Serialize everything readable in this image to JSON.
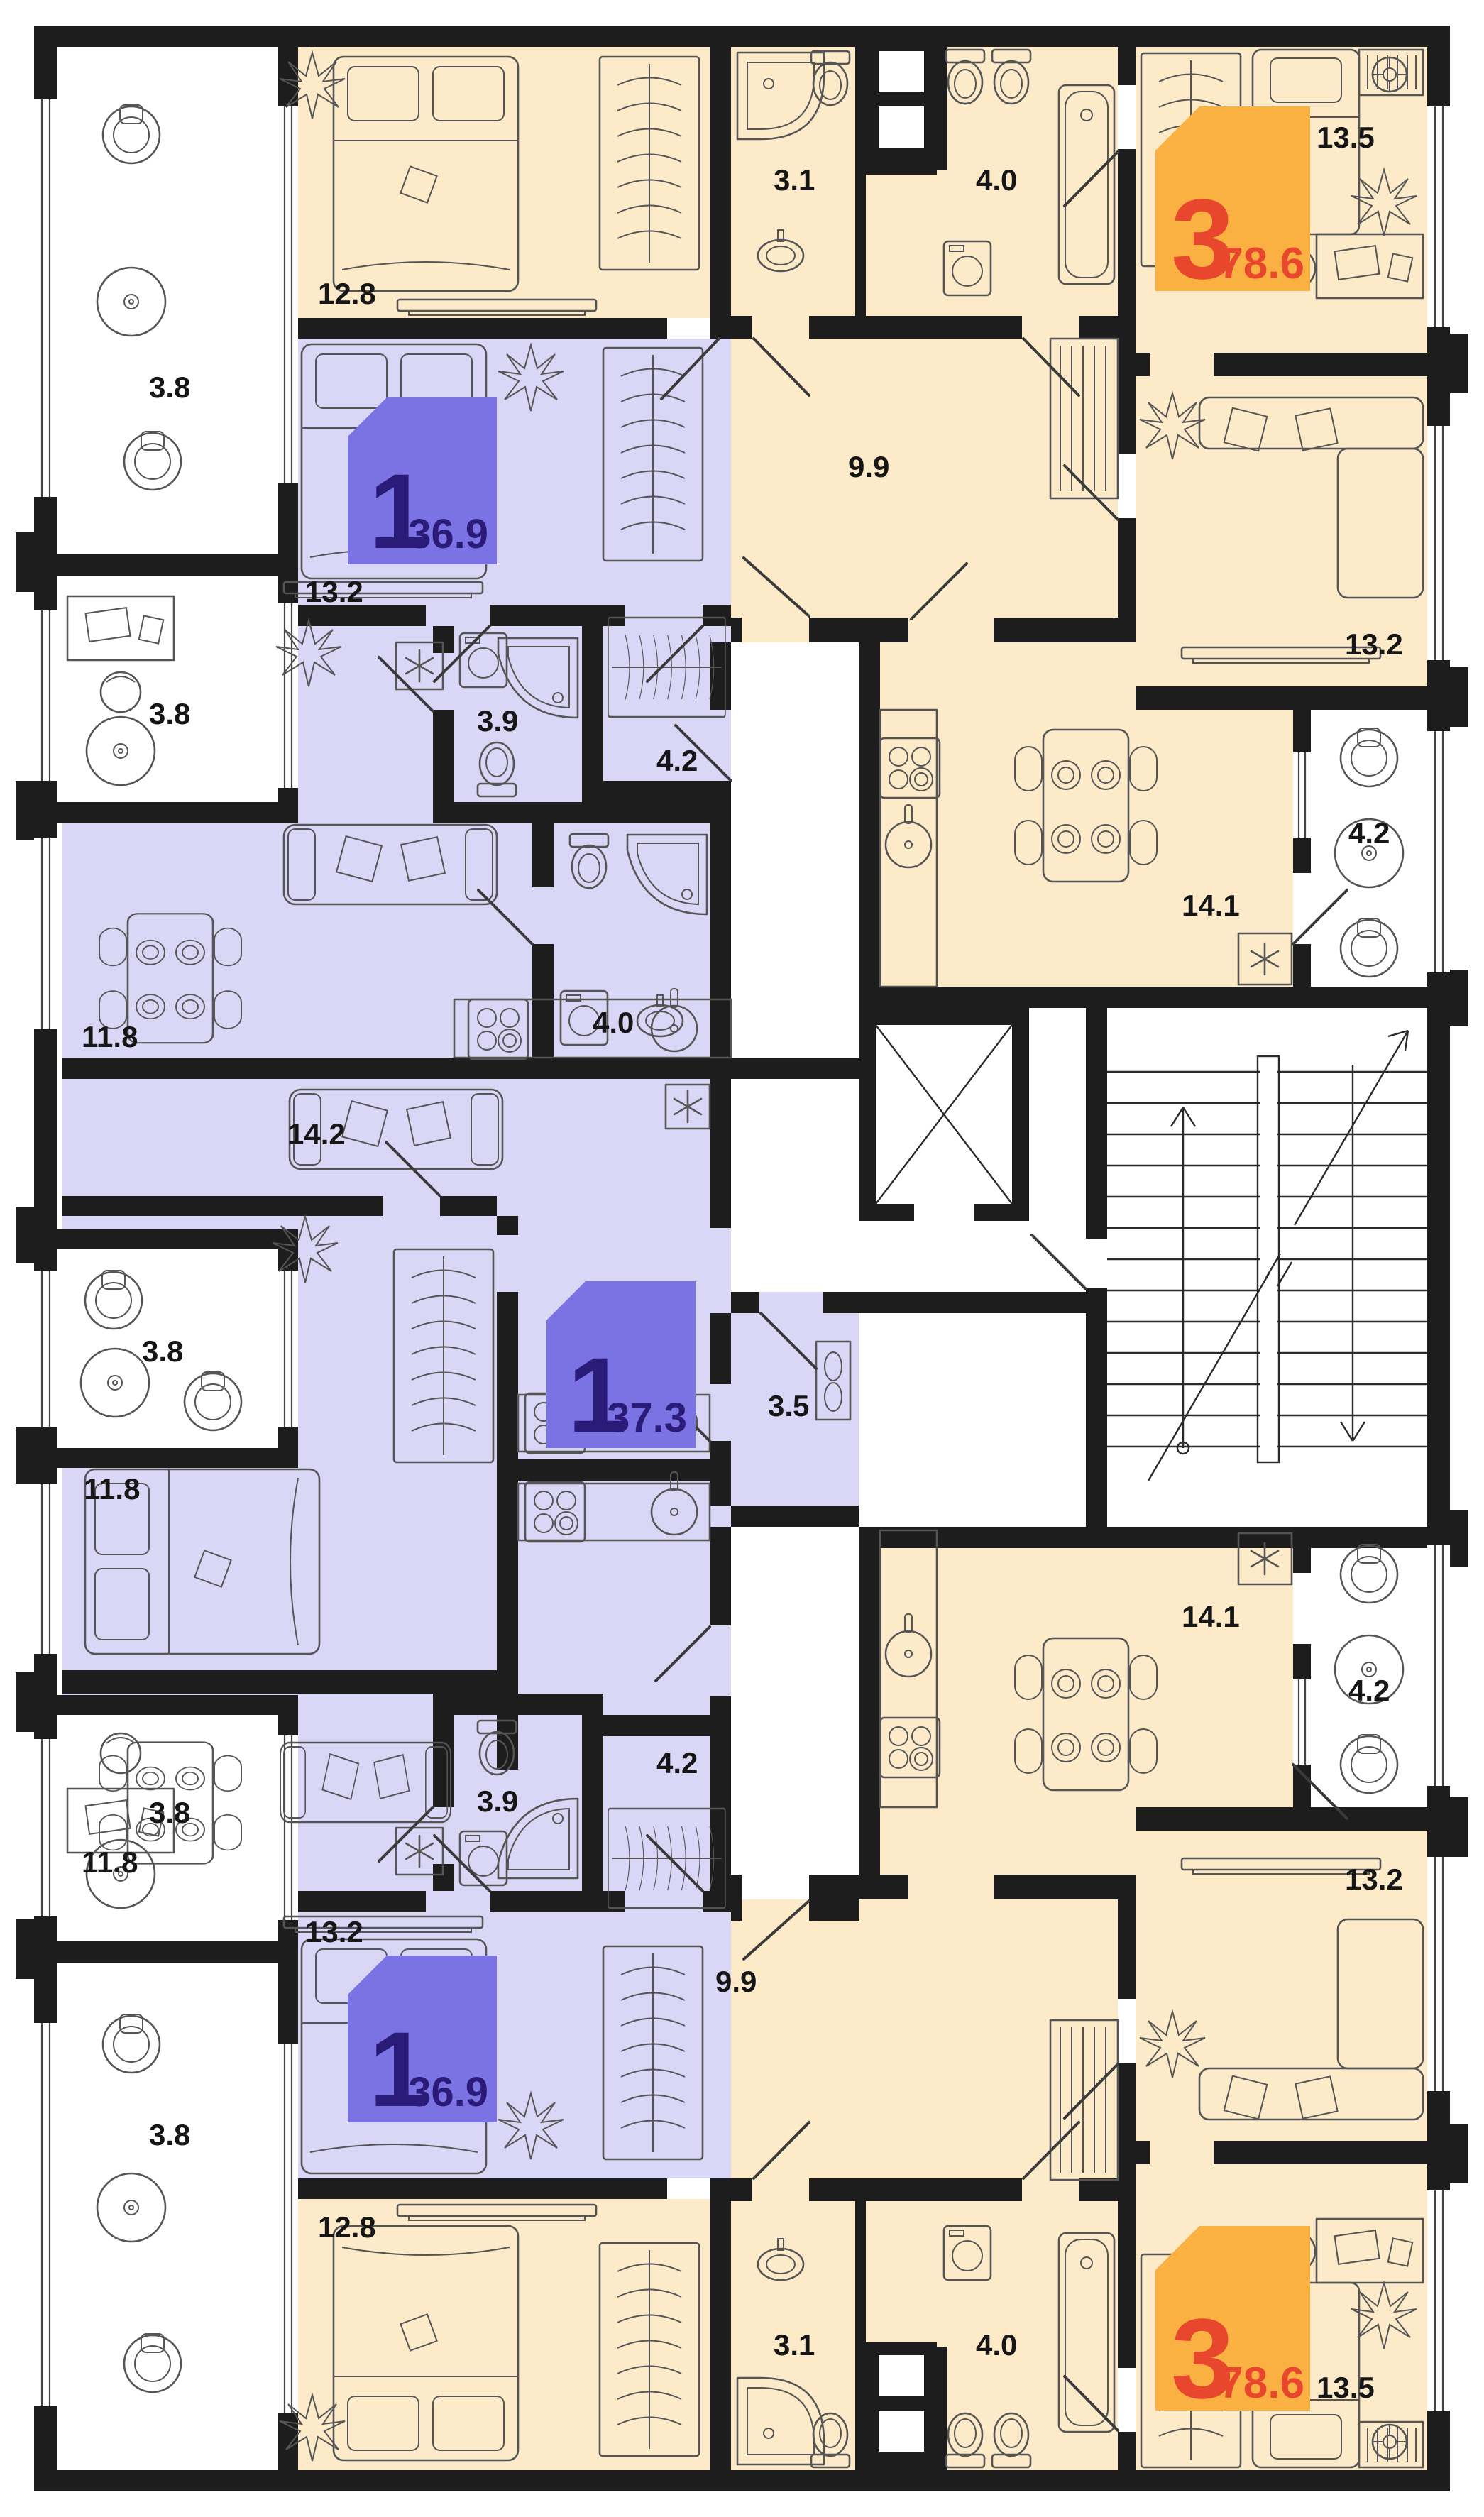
{
  "plan_type": "residential-floor-plan",
  "colors": {
    "wall": "#1d1d1d",
    "orange": "#fceac8",
    "purple": "#dad6f5",
    "badge1": "#7b72e4",
    "badge1-text": "#2a1b78",
    "badge3": "#fbb042",
    "badge-red": "#e8472e"
  },
  "apartments": [
    {
      "id": "three-room-top",
      "rooms_count": "3",
      "total_area": "78.6",
      "fill": "orange",
      "rooms": [
        {
          "name": "bedroom",
          "area": "12.8"
        },
        {
          "name": "bathroom",
          "area": "3.1"
        },
        {
          "name": "bathroom",
          "area": "4.0"
        },
        {
          "name": "hallway",
          "area": "9.9"
        },
        {
          "name": "bedroom",
          "area": "13.5"
        },
        {
          "name": "living-room",
          "area": "13.2"
        },
        {
          "name": "kitchen",
          "area": "14.1"
        },
        {
          "name": "balcony",
          "area": "4.2"
        },
        {
          "name": "balcony",
          "area": "3.8"
        }
      ]
    },
    {
      "id": "one-room-upper",
      "rooms_count": "1",
      "total_area": "36.9",
      "fill": "purple",
      "rooms": [
        {
          "name": "bedroom",
          "area": "13.2"
        },
        {
          "name": "dressing",
          "area": "4.2"
        },
        {
          "name": "bathroom",
          "area": "3.9"
        },
        {
          "name": "living-kitchen",
          "area": "11.8"
        },
        {
          "name": "balcony",
          "area": "3.8"
        }
      ]
    },
    {
      "id": "one-room-middle",
      "rooms_count": "1",
      "total_area": "37.3",
      "fill": "purple",
      "rooms": [
        {
          "name": "living-kitchen",
          "area": "14.2"
        },
        {
          "name": "bedroom",
          "area": "11.8"
        },
        {
          "name": "bathroom",
          "area": "4.0"
        },
        {
          "name": "hallway",
          "area": "3.5"
        },
        {
          "name": "balcony",
          "area": "3.8"
        }
      ]
    },
    {
      "id": "one-room-lower",
      "rooms_count": "1",
      "total_area": "36.9",
      "fill": "purple",
      "rooms": [
        {
          "name": "living-kitchen",
          "area": "11.8"
        },
        {
          "name": "bathroom",
          "area": "3.9"
        },
        {
          "name": "dressing",
          "area": "4.2"
        },
        {
          "name": "bedroom",
          "area": "13.2"
        },
        {
          "name": "balcony",
          "area": "3.8"
        }
      ]
    },
    {
      "id": "three-room-bottom",
      "rooms_count": "3",
      "total_area": "78.6",
      "fill": "orange",
      "rooms": [
        {
          "name": "bedroom",
          "area": "12.8"
        },
        {
          "name": "bathroom",
          "area": "3.1"
        },
        {
          "name": "bathroom",
          "area": "4.0"
        },
        {
          "name": "hallway",
          "area": "9.9"
        },
        {
          "name": "bedroom",
          "area": "13.5"
        },
        {
          "name": "living-room",
          "area": "13.2"
        },
        {
          "name": "kitchen",
          "area": "14.1"
        },
        {
          "name": "balcony",
          "area": "4.2"
        },
        {
          "name": "balcony",
          "area": "3.8"
        }
      ]
    }
  ],
  "badges": [
    {
      "type": "1",
      "area": "36.9"
    },
    {
      "type": "1",
      "area": "37.3"
    },
    {
      "type": "1",
      "area": "36.9"
    },
    {
      "type": "3",
      "area": "78.6"
    },
    {
      "type": "3",
      "area": "78.6"
    }
  ],
  "labels": [
    {
      "room": "balcony-top-left",
      "text": "3.8"
    },
    {
      "room": "bedroom-orange-top",
      "text": "12.8"
    },
    {
      "room": "bath-small-top",
      "text": "3.1"
    },
    {
      "room": "bath-large-top",
      "text": "4.0"
    },
    {
      "room": "hallway-orange-top",
      "text": "9.9"
    },
    {
      "room": "bedroom-13-5-top",
      "text": "13.5"
    },
    {
      "room": "living-13-2-top",
      "text": "13.2"
    },
    {
      "room": "kitchen-top",
      "text": "14.1"
    },
    {
      "room": "balcony-right-top",
      "text": "4.2"
    },
    {
      "room": "bedroom-purple-upper",
      "text": "13.2"
    },
    {
      "room": "balcony-left-2",
      "text": "3.8"
    },
    {
      "room": "dressing-upper",
      "text": "4.2"
    },
    {
      "room": "bath-purple-upper",
      "text": "3.9"
    },
    {
      "room": "living-purple-upper",
      "text": "11.8"
    },
    {
      "room": "bath-purple-middle",
      "text": "4.0"
    },
    {
      "room": "hall-purple-middle",
      "text": "3.5"
    },
    {
      "room": "living-purple-middle",
      "text": "14.2"
    },
    {
      "room": "bedroom-purple-middle",
      "text": "11.8"
    },
    {
      "room": "balcony-left-3",
      "text": "3.8"
    },
    {
      "room": "living-purple-lower",
      "text": "11.8"
    },
    {
      "room": "bath-purple-lower",
      "text": "3.9"
    },
    {
      "room": "dressing-lower",
      "text": "4.2"
    },
    {
      "room": "balcony-left-4",
      "text": "3.8"
    },
    {
      "room": "bedroom-purple-lower",
      "text": "13.2"
    },
    {
      "room": "balcony-left-5",
      "text": "3.8"
    },
    {
      "room": "bedroom-orange-bottom",
      "text": "12.8"
    },
    {
      "room": "bath-small-bottom",
      "text": "3.1"
    },
    {
      "room": "bath-large-bottom",
      "text": "4.0"
    },
    {
      "room": "hallway-orange-bottom",
      "text": "9.9"
    },
    {
      "room": "living-13-2-bottom",
      "text": "13.2"
    },
    {
      "room": "kitchen-bottom",
      "text": "14.1"
    },
    {
      "room": "balcony-right-bottom",
      "text": "4.2"
    },
    {
      "room": "bedroom-13-5-bottom",
      "text": "13.5"
    }
  ]
}
